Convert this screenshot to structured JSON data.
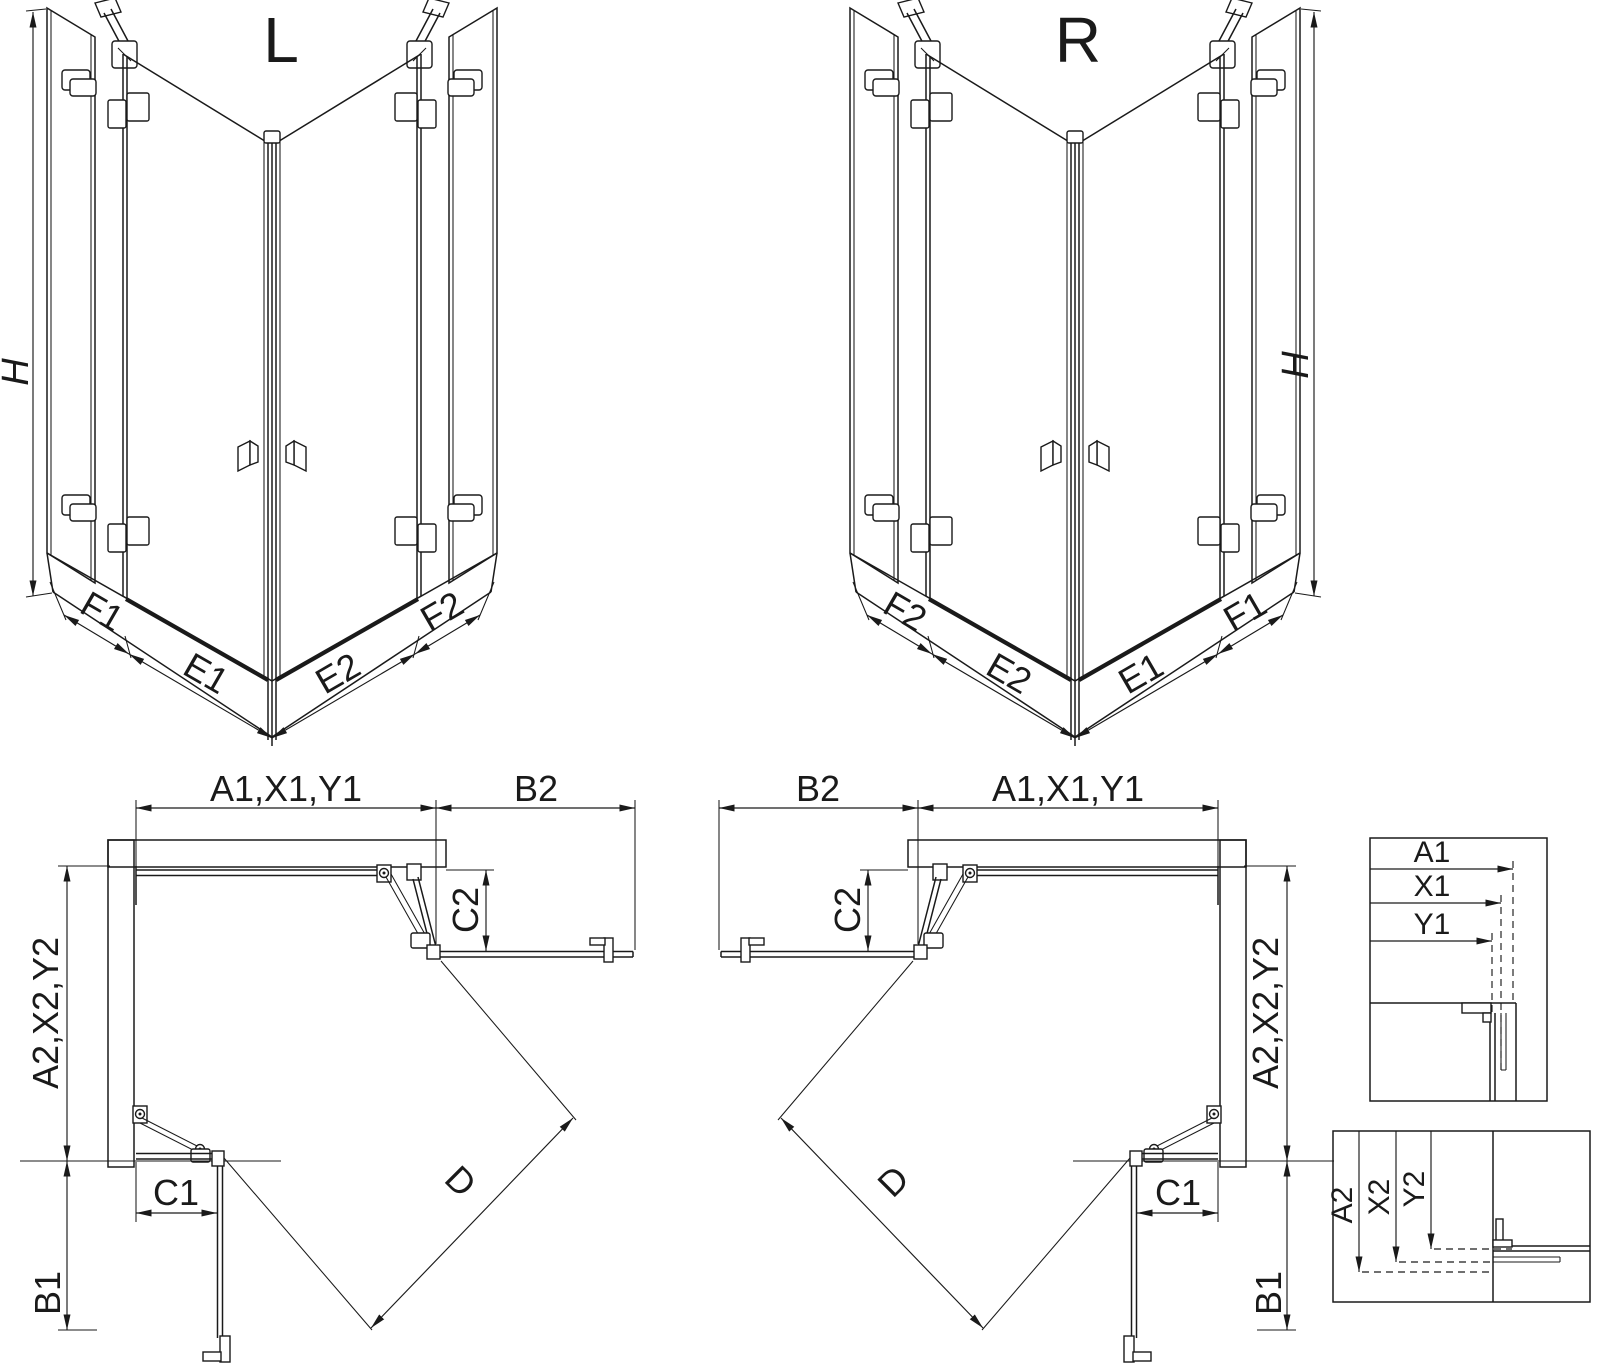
{
  "diagram": {
    "background": "#ffffff",
    "line_color": "#1a1a1a",
    "view_l": {
      "title": "L",
      "height": "H",
      "f_outer_left": "F1",
      "door_left": "E1",
      "door_right": "E2",
      "f_outer_right": "F2"
    },
    "view_r": {
      "title": "R",
      "height": "H",
      "f_outer_left": "F2",
      "door_left": "E2",
      "door_right": "E1",
      "f_outer_right": "F1"
    },
    "plan_l": {
      "top_width": "A1,X1,Y1",
      "return_top": "B2",
      "door_offset_top": "C2",
      "side_depth": "A2,X2,Y2",
      "door_offset_bottom": "C1",
      "return_bottom": "B1",
      "diagonal": "D"
    },
    "plan_r": {
      "top_width": "A1,X1,Y1",
      "return_top": "B2",
      "door_offset_top": "C2",
      "side_depth": "A2,X2,Y2",
      "door_offset_bottom": "C1",
      "return_bottom": "B1",
      "diagonal": "D"
    },
    "detail_top": {
      "a1": "A1",
      "x1": "X1",
      "y1": "Y1"
    },
    "detail_bottom": {
      "a2": "A2",
      "x2": "X2",
      "y2": "Y2"
    }
  }
}
